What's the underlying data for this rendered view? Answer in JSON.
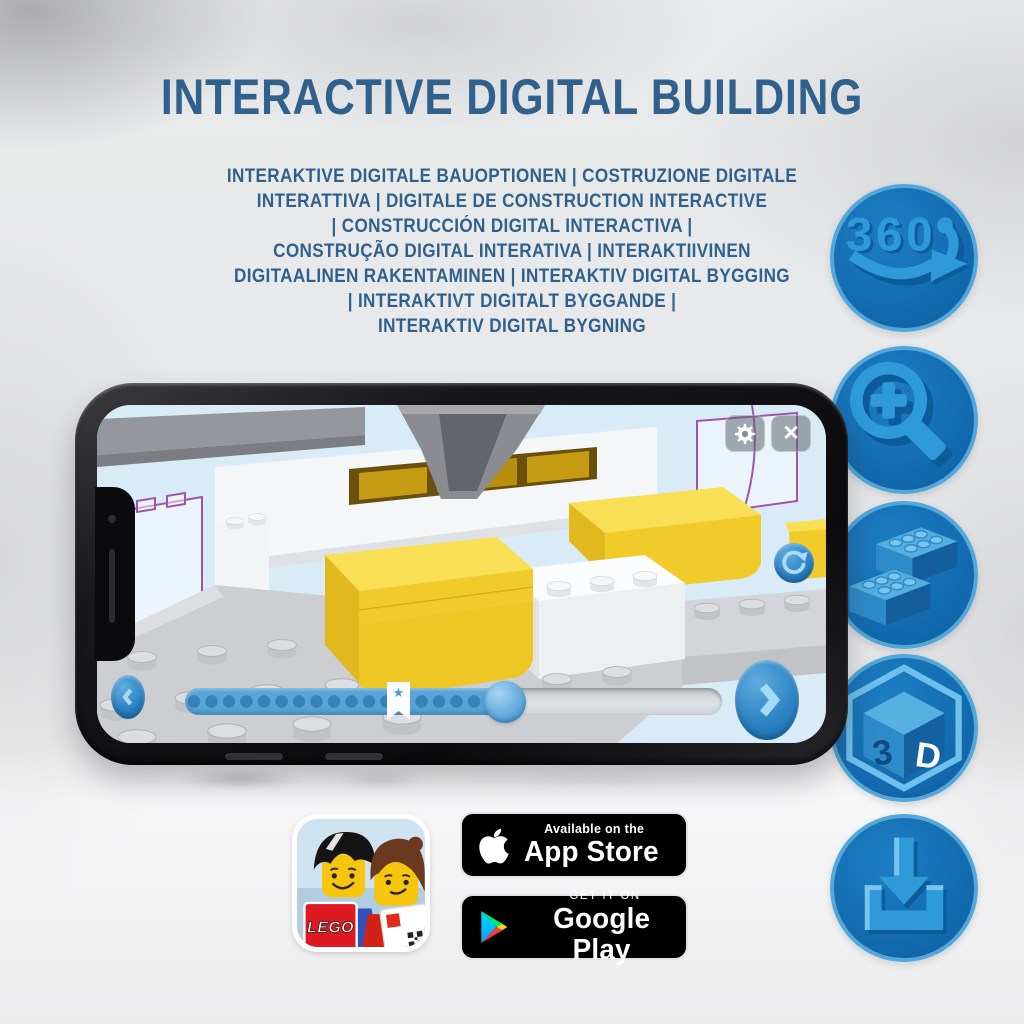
{
  "title": "INTERACTIVE DIGITAL BUILDING",
  "subtitle_lines": [
    "INTERAKTIVE DIGITALE BAUOPTIONEN | COSTRUZIONE DIGITALE",
    "INTERATTIVA | DIGITALE DE CONSTRUCTION INTERACTIVE",
    "| CONSTRUCCIÓN DIGITAL INTERACTIVA |",
    "CONSTRUÇÃO DIGITAL INTERATIVA | INTERAKTIIVINEN",
    "DIGITAALINEN RAKENTAMINEN | INTERAKTIV DIGITAL BYGGING",
    "| INTERAKTIVT DIGITALT BYGGANDE |",
    "INTERAKTIV DIGITAL BYGNING"
  ],
  "features": {
    "rotation_label": "360º",
    "cube_3": "3",
    "cube_d": "D",
    "icon_names": [
      "360-rotation",
      "zoom-in",
      "lego-bricks",
      "3d-view",
      "download"
    ]
  },
  "phone": {
    "close_glyph": "✕",
    "marker_star": "★",
    "progress": {
      "filled_percent": 61,
      "marker_percent": 40
    }
  },
  "badges": {
    "app_store": {
      "line1": "Available on the",
      "line2": "App Store"
    },
    "google_play": {
      "line1": "GET IT ON",
      "line2": "Google Play"
    },
    "lego_logo": "LEGO"
  },
  "colors": {
    "headline": "#30608c",
    "icon_circle_fill": "#1571b4",
    "icon_circle_ring": "#54a7da",
    "icon_glyph": "#2f9ad8",
    "screen_sky": "#d9ebf7",
    "lego_yellow": "#f0cb29",
    "ui_blue": "#58a4d8",
    "badge_bg": "#000000"
  }
}
